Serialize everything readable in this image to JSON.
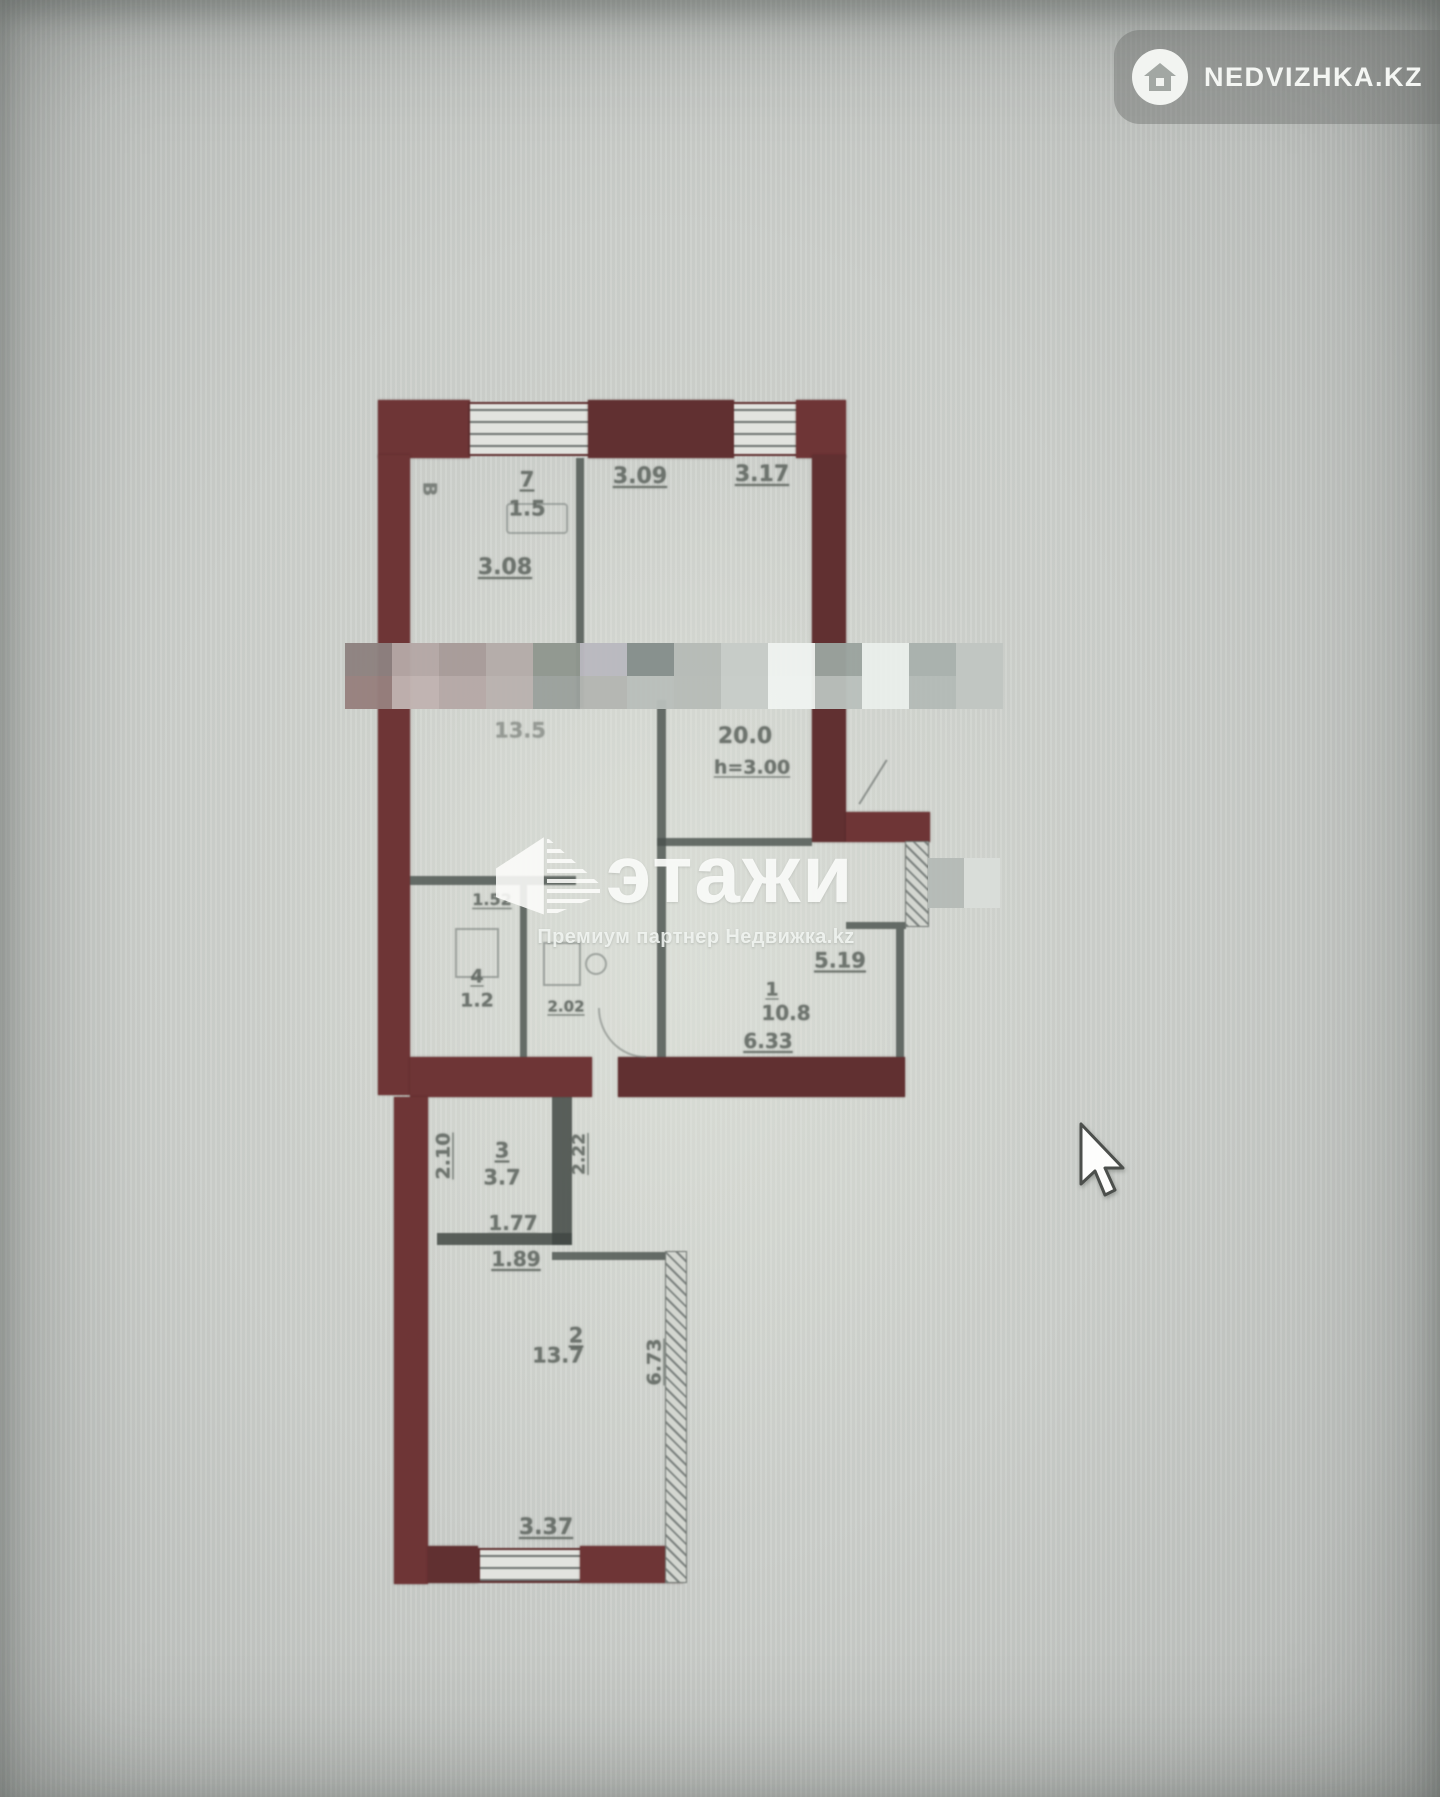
{
  "badge": {
    "label": "NEDVIZHKA.KZ",
    "icon": "house-icon"
  },
  "watermark": {
    "logo": "этажи",
    "subtitle": "Премиум партнер Недвижка.kz",
    "icon": "building-3d-icon"
  },
  "plan": {
    "type": "apartment-floor-plan",
    "wall_color": "#6d2f30",
    "line_color": "#474f4b",
    "label_color": "#565d57",
    "rooms": [
      {
        "number": "7",
        "area": "1.5"
      },
      {
        "number": "",
        "area": "13.5"
      },
      {
        "number": "",
        "area": "20.0",
        "note": "h=3.00"
      },
      {
        "number": "4",
        "area": "1.2"
      },
      {
        "number": "1",
        "area": "10.8"
      },
      {
        "number": "3",
        "area": "3.7"
      },
      {
        "number": "2",
        "area": "13.7"
      }
    ],
    "dimensions": [
      "3.09",
      "3.17",
      "3.08",
      "1.52",
      "2.02",
      "5.19",
      "6.33",
      "2.10",
      "2.22",
      "1.77",
      "1.89",
      "6.73",
      "3.37"
    ],
    "labels": [
      {
        "t": "В",
        "x": 429,
        "y": 489,
        "s": 19,
        "r": 90,
        "o": 0.7
      },
      {
        "t": "7",
        "x": 527,
        "y": 480,
        "s": 21,
        "u": true
      },
      {
        "t": "1.5",
        "x": 527,
        "y": 509,
        "s": 21
      },
      {
        "t": "3.09",
        "x": 640,
        "y": 477,
        "s": 22,
        "u": true
      },
      {
        "t": "3.17",
        "x": 762,
        "y": 475,
        "s": 22,
        "u": true
      },
      {
        "t": "3.08",
        "x": 505,
        "y": 568,
        "s": 22,
        "u": true
      },
      {
        "t": "13.5",
        "x": 520,
        "y": 731,
        "s": 21,
        "o": 0.5
      },
      {
        "t": "20.0",
        "x": 745,
        "y": 737,
        "s": 22
      },
      {
        "t": "h=3.00",
        "x": 752,
        "y": 768,
        "s": 19,
        "u": true
      },
      {
        "t": "1.52",
        "x": 492,
        "y": 900,
        "s": 16,
        "u": true
      },
      {
        "t": "4",
        "x": 477,
        "y": 977,
        "s": 19,
        "u": true
      },
      {
        "t": "1.2",
        "x": 477,
        "y": 1001,
        "s": 19
      },
      {
        "t": "2.02",
        "x": 566,
        "y": 1007,
        "s": 15,
        "u": true
      },
      {
        "t": "5.19",
        "x": 840,
        "y": 961,
        "s": 21,
        "u": true
      },
      {
        "t": "1",
        "x": 772,
        "y": 990,
        "s": 19,
        "u": true
      },
      {
        "t": "10.8",
        "x": 786,
        "y": 1013,
        "s": 20
      },
      {
        "t": "6.33",
        "x": 768,
        "y": 1041,
        "s": 20,
        "u": true
      },
      {
        "t": "2.10",
        "x": 444,
        "y": 1156,
        "s": 19,
        "r": -90,
        "u": true
      },
      {
        "t": "3",
        "x": 502,
        "y": 1151,
        "s": 21,
        "u": true
      },
      {
        "t": "3.7",
        "x": 502,
        "y": 1178,
        "s": 21
      },
      {
        "t": "2.22",
        "x": 580,
        "y": 1154,
        "s": 17,
        "r": -90,
        "u": true
      },
      {
        "t": "1.77",
        "x": 513,
        "y": 1223,
        "s": 20,
        "u": true
      },
      {
        "t": "1.89",
        "x": 516,
        "y": 1259,
        "s": 20,
        "u": true
      },
      {
        "t": "2",
        "x": 576,
        "y": 1336,
        "s": 21,
        "u": true
      },
      {
        "t": "13.7",
        "x": 558,
        "y": 1356,
        "s": 21
      },
      {
        "t": "6.73",
        "x": 655,
        "y": 1362,
        "s": 19,
        "r": -90,
        "u": true
      },
      {
        "t": "3.37",
        "x": 546,
        "y": 1528,
        "s": 22,
        "u": true
      }
    ],
    "mosaic": {
      "x": 345,
      "y": 643,
      "cell_w": 47,
      "cell_h": 33,
      "rows": [
        [
          "#8e8280",
          "#b5a8a6",
          "#a89b99",
          "#b4aca9",
          "#90978f",
          "#bab9c0",
          "#858f8c",
          "#b6bbb7",
          "#c7ccc8",
          "#eff3f0",
          "#9ba49f",
          "#eaefeb",
          "#a9b1ad",
          "#c1c6c2"
        ],
        [
          "#97807e",
          "#c1b3b1",
          "#b6a9a7",
          "#bab2af",
          "#9ba19d",
          "#b4b6b2",
          "#b9bfbb",
          "#b7bcb8",
          "#c8cdc9",
          "#f0f4f1",
          "#bac1bd",
          "#eaefeb",
          "#b4bbb7",
          "#c1c6c2"
        ]
      ]
    },
    "mosaic_small": {
      "x": 928,
      "y": 858,
      "cell_w": 36,
      "cell_h": 50,
      "rows": [
        [
          "#b5bbb7",
          "#dadeda"
        ]
      ]
    }
  },
  "cursor": {
    "type": "arrow-pointer"
  }
}
